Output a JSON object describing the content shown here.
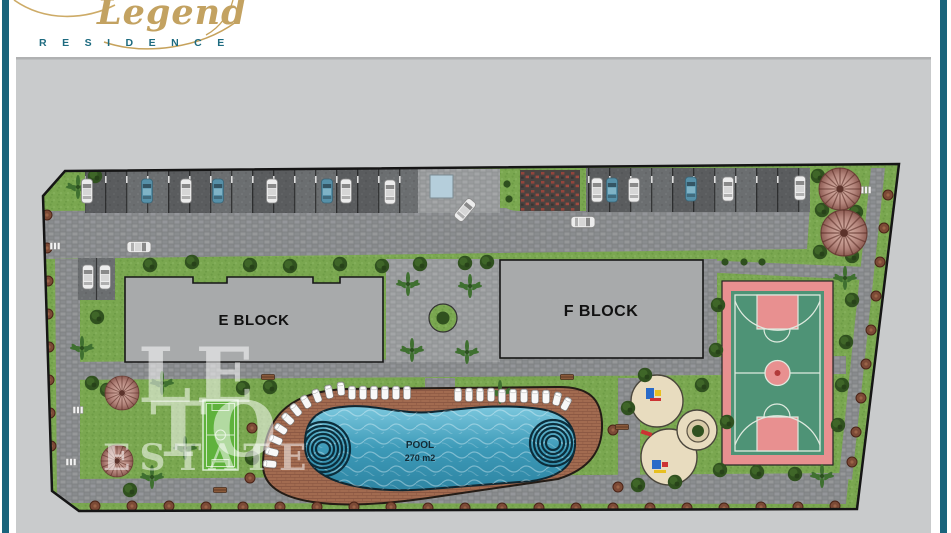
{
  "brand": {
    "script": "Legend",
    "subtitle": "RESIDENCE"
  },
  "plan": {
    "block_e": "E BLOCK",
    "block_f": "F BLOCK",
    "pool_title": "POOL",
    "pool_area": "270 m2"
  },
  "watermark": {
    "line1": "LE",
    "line2": "TO",
    "line3": "ESTATE"
  },
  "colors": {
    "accent_teal": "#19647c",
    "brand_gold": "#c3a261",
    "plan_background": "#c9cbcc",
    "grass": "#7aa750",
    "road": "#8d9092",
    "pool_water": "#3f9cba",
    "pool_deck": "#a26b50",
    "court_green": "#4e9376",
    "court_pink": "#e89090",
    "playground_sand": "#e8dcbf",
    "building_gray": "#a8aaab"
  },
  "decor": {
    "trees_green": [
      [
        95,
        176
      ],
      [
        150,
        265
      ],
      [
        192,
        262
      ],
      [
        250,
        265
      ],
      [
        290,
        266
      ],
      [
        340,
        264
      ],
      [
        382,
        266
      ],
      [
        420,
        264
      ],
      [
        465,
        263
      ],
      [
        487,
        262
      ],
      [
        97,
        317
      ],
      [
        818,
        176
      ],
      [
        845,
        180
      ],
      [
        822,
        210
      ],
      [
        856,
        212
      ],
      [
        820,
        252
      ],
      [
        852,
        256
      ],
      [
        718,
        305
      ],
      [
        716,
        350
      ],
      [
        852,
        300
      ],
      [
        846,
        342
      ],
      [
        842,
        385
      ],
      [
        838,
        425
      ],
      [
        720,
        470
      ],
      [
        757,
        472
      ],
      [
        795,
        474
      ],
      [
        645,
        375
      ],
      [
        702,
        385
      ],
      [
        727,
        422
      ],
      [
        675,
        482
      ],
      [
        638,
        485
      ],
      [
        628,
        408
      ],
      [
        270,
        387
      ],
      [
        92,
        383
      ],
      [
        107,
        390
      ],
      [
        243,
        388
      ],
      [
        252,
        458
      ],
      [
        130,
        490
      ]
    ],
    "trees_brown": [
      [
        95,
        506
      ],
      [
        132,
        506
      ],
      [
        169,
        506
      ],
      [
        206,
        507
      ],
      [
        243,
        507
      ],
      [
        280,
        507
      ],
      [
        317,
        507
      ],
      [
        354,
        507
      ],
      [
        391,
        507
      ],
      [
        428,
        508
      ],
      [
        465,
        508
      ],
      [
        502,
        508
      ],
      [
        539,
        508
      ],
      [
        576,
        508
      ],
      [
        613,
        508
      ],
      [
        650,
        508
      ],
      [
        687,
        508
      ],
      [
        724,
        508
      ],
      [
        761,
        507
      ],
      [
        798,
        507
      ],
      [
        835,
        506
      ],
      [
        47,
        215
      ],
      [
        47,
        248
      ],
      [
        48,
        281
      ],
      [
        48,
        314
      ],
      [
        49,
        347
      ],
      [
        49,
        380
      ],
      [
        50,
        413
      ],
      [
        51,
        446
      ],
      [
        888,
        195
      ],
      [
        884,
        228
      ],
      [
        880,
        262
      ],
      [
        876,
        296
      ],
      [
        871,
        330
      ],
      [
        866,
        364
      ],
      [
        861,
        398
      ],
      [
        856,
        432
      ],
      [
        852,
        462
      ],
      [
        252,
        428
      ],
      [
        250,
        478
      ],
      [
        613,
        430
      ],
      [
        618,
        487
      ]
    ],
    "palms": [
      [
        78,
        187
      ],
      [
        82,
        348
      ],
      [
        408,
        284
      ],
      [
        470,
        286
      ],
      [
        412,
        350
      ],
      [
        467,
        352
      ],
      [
        845,
        278
      ],
      [
        822,
        476
      ],
      [
        162,
        383
      ],
      [
        185,
        448
      ],
      [
        152,
        477
      ],
      [
        500,
        392
      ]
    ],
    "bushes": [
      [
        507,
        184
      ],
      [
        509,
        199
      ],
      [
        725,
        262
      ],
      [
        744,
        262
      ],
      [
        762,
        262
      ]
    ],
    "cars_white": [
      [
        87,
        191
      ],
      [
        186,
        191
      ],
      [
        272,
        191
      ],
      [
        346,
        191
      ],
      [
        390,
        192
      ],
      [
        597,
        190
      ],
      [
        634,
        190
      ],
      [
        728,
        189
      ],
      [
        800,
        188
      ],
      [
        88,
        277
      ],
      [
        105,
        277
      ],
      [
        139,
        247,
        90
      ],
      [
        583,
        222,
        90
      ],
      [
        465,
        210,
        40
      ]
    ],
    "cars_teal": [
      [
        147,
        191
      ],
      [
        218,
        191
      ],
      [
        327,
        191
      ],
      [
        612,
        190
      ],
      [
        691,
        189
      ]
    ],
    "loungers": [
      [
        270,
        464,
        -85
      ],
      [
        272,
        452,
        -76
      ],
      [
        276,
        440,
        -66
      ],
      [
        281,
        429,
        -57
      ],
      [
        288,
        419,
        -48
      ],
      [
        296,
        410,
        -39
      ],
      [
        306,
        402,
        -30
      ],
      [
        317,
        396,
        -21
      ],
      [
        329,
        392,
        -12
      ],
      [
        341,
        389,
        -5
      ],
      [
        352,
        393,
        0
      ],
      [
        363,
        393,
        0
      ],
      [
        374,
        393,
        0
      ],
      [
        385,
        393,
        0
      ],
      [
        396,
        393,
        0
      ],
      [
        407,
        393,
        0
      ],
      [
        458,
        395,
        0
      ],
      [
        469,
        395,
        0
      ],
      [
        480,
        395,
        0
      ],
      [
        491,
        395,
        0
      ],
      [
        502,
        396,
        0
      ],
      [
        513,
        396,
        0
      ],
      [
        524,
        396,
        0
      ],
      [
        535,
        397,
        0
      ],
      [
        546,
        397,
        0
      ],
      [
        557,
        399,
        14
      ],
      [
        566,
        404,
        28
      ]
    ],
    "benches": [
      [
        268,
        377
      ],
      [
        567,
        377
      ],
      [
        622,
        427
      ],
      [
        220,
        490
      ]
    ],
    "white_benches": [
      [
        866,
        190
      ],
      [
        861,
        236
      ],
      [
        78,
        410
      ],
      [
        71,
        462
      ],
      [
        55,
        246
      ]
    ],
    "gazebos": [
      [
        840,
        189,
        1.05
      ],
      [
        844,
        233,
        1.15
      ],
      [
        122,
        393,
        0.85
      ],
      [
        117,
        461,
        0.8
      ]
    ]
  }
}
